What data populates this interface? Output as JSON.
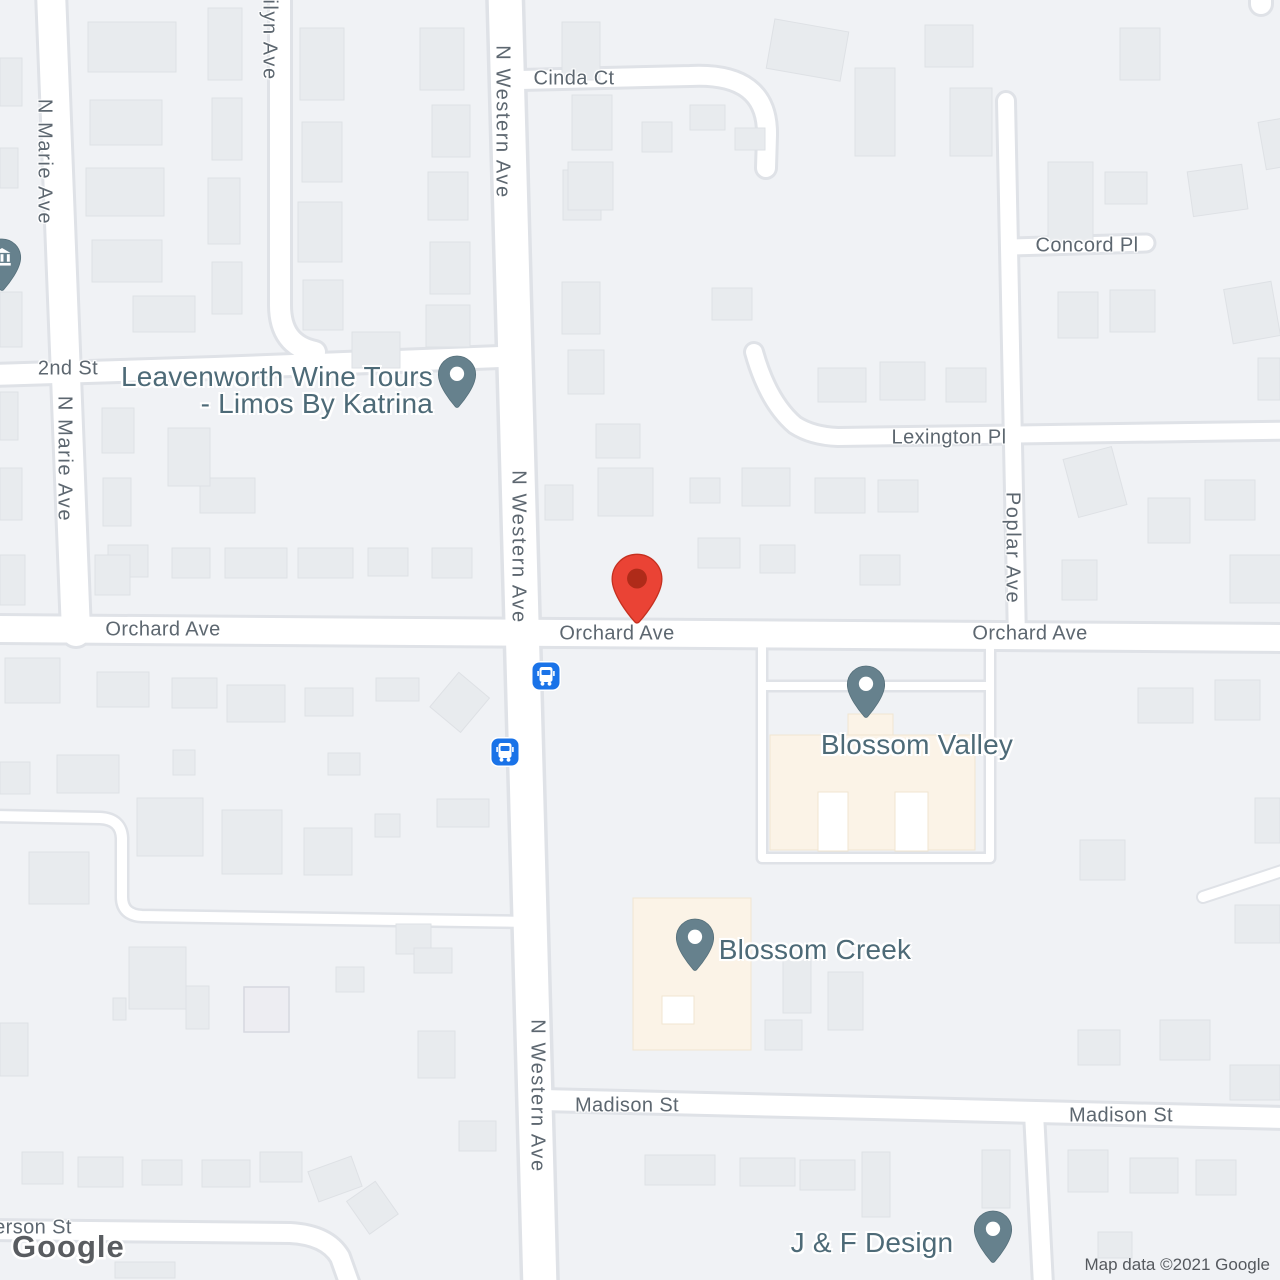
{
  "map": {
    "colors": {
      "background": "#f0f2f5",
      "road_fill": "#ffffff",
      "road_casing": "#dfe2e7",
      "building_fill": "#e8ebee",
      "highlight_building": "#fbf3e7",
      "street_label": "#5d6770",
      "poi_label": "#4d6a77",
      "poi_pin": "#66818d",
      "destination_marker": "#ea4335",
      "bus_stop": "#1a73e8"
    },
    "street_labels": [
      {
        "text": "Cinda Ct"
      },
      {
        "text": "N Western Ave"
      },
      {
        "text": "ilyn Ave"
      },
      {
        "text": "N Marie Ave"
      },
      {
        "text": "Concord Pl"
      },
      {
        "text": "2nd St"
      },
      {
        "text": "N Marie Ave"
      },
      {
        "text": "Lexington Pl"
      },
      {
        "text": "N Western Ave"
      },
      {
        "text": "Poplar Ave"
      },
      {
        "text": "Orchard Ave"
      },
      {
        "text": "Orchard Ave"
      },
      {
        "text": "Orchard Ave"
      },
      {
        "text": "Madison St"
      },
      {
        "text": "Madison St"
      },
      {
        "text": "N Western Ave"
      },
      {
        "text": "erson St"
      }
    ],
    "pois": [
      {
        "name": "Leavenworth Wine Tours - Limos By Katrina",
        "lines": [
          "Leavenworth Wine Tours",
          "- Limos By Katrina"
        ]
      },
      {
        "name": "Blossom Valley"
      },
      {
        "name": "Blossom Creek"
      },
      {
        "name": "J & F Design"
      }
    ],
    "bus_stops": [
      {
        "x": 546,
        "y": 676
      },
      {
        "x": 505,
        "y": 752
      }
    ],
    "logo_text": "Google",
    "attribution": "Map data ©2021 Google"
  }
}
